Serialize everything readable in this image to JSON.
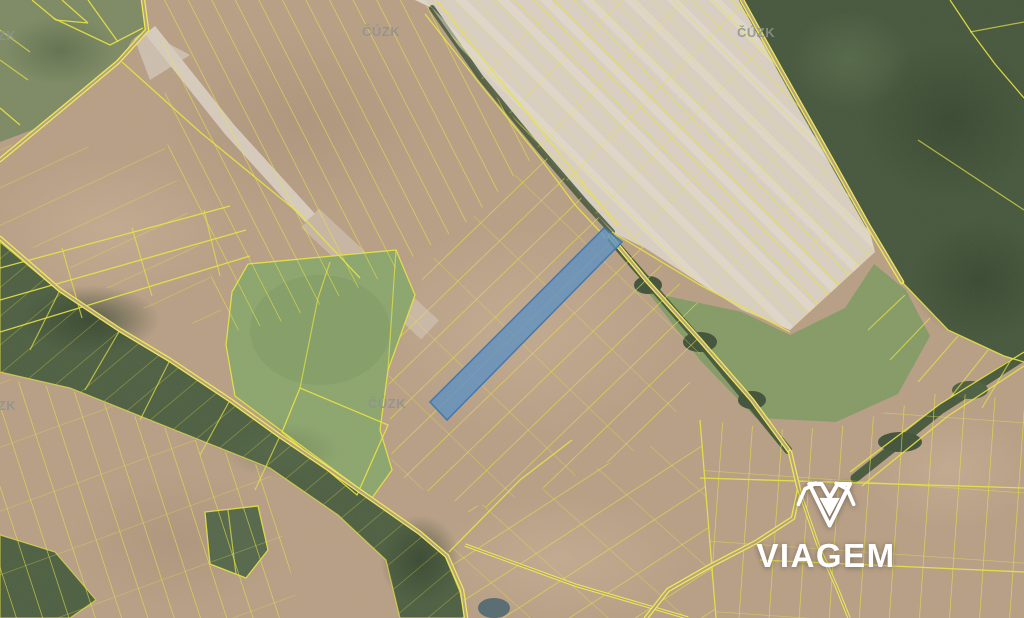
{
  "map": {
    "kind": "cadastral-orthophoto",
    "watermark_text": "ČÚZK",
    "logo_text": "VIAGEM",
    "highlighted_parcel": {
      "fill": "#5B90C2",
      "border": "#3E76AD",
      "fill_opacity": "0.8"
    },
    "parcel_line_color": "#E9E43E",
    "watermark_color": "#8E948E",
    "logo_color": "#FFFFFF"
  }
}
